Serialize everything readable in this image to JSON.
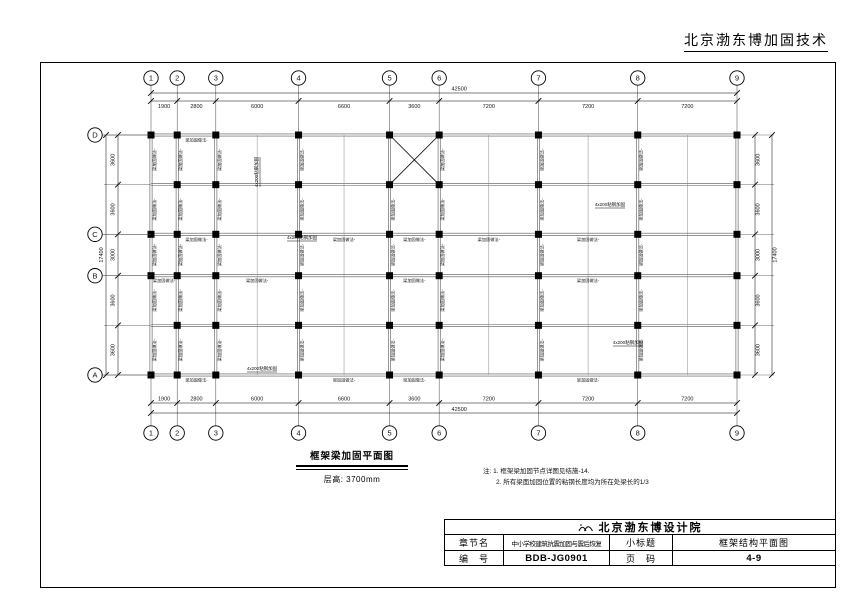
{
  "header": {
    "company": "北京渤东博加固技术"
  },
  "plan": {
    "x_axes": [
      "1",
      "2",
      "3",
      "4",
      "5",
      "6",
      "7",
      "8",
      "9"
    ],
    "x_dims": [
      1900,
      2800,
      6000,
      6600,
      3600,
      7200,
      7200,
      7200
    ],
    "x_total": "42500",
    "y_axes": [
      "D",
      "",
      "C",
      "B",
      "",
      "A"
    ],
    "y_dims": [
      3600,
      3600,
      3000,
      3600,
      3600
    ],
    "y_total": "17400",
    "beam_label": "梁加固做法-",
    "steel_label": "4x200粘钢加固",
    "h_labels": [
      [
        0,
        1
      ],
      [
        2,
        1
      ],
      [
        2,
        3
      ],
      [
        2,
        4
      ],
      [
        2,
        5
      ],
      [
        2,
        6
      ],
      [
        3,
        0
      ],
      [
        3,
        2
      ],
      [
        3,
        4
      ],
      [
        3,
        6
      ],
      [
        5,
        1
      ],
      [
        5,
        3
      ],
      [
        5,
        4
      ],
      [
        5,
        6
      ]
    ],
    "steel_positions": [
      [
        258,
        172,
        -90
      ],
      [
        610,
        206,
        0
      ],
      [
        302,
        239,
        0
      ],
      [
        628,
        344,
        0
      ],
      [
        262,
        370,
        0
      ]
    ],
    "braced_bay": {
      "col": 4,
      "row": 0
    }
  },
  "caption": {
    "title": "框架梁加固平面图",
    "subtitle": "层高: 3700mm"
  },
  "notes": {
    "line1": "注: 1. 框架梁加固节点详图见结施-14.",
    "line2": "2. 所有梁面加固位置的粘钢长度均为所在处梁长的1/3"
  },
  "title_block": {
    "institute": "北京渤东博设计院",
    "rows": [
      {
        "label": "章节名",
        "value": "中小学校建筑抗震加固与震后恢复",
        "label2": "小标题",
        "value2": "框架结构平面图"
      },
      {
        "label": "编　号",
        "value": "BDB-JG0901",
        "label2": "页　码",
        "value2": "4-9"
      }
    ]
  }
}
